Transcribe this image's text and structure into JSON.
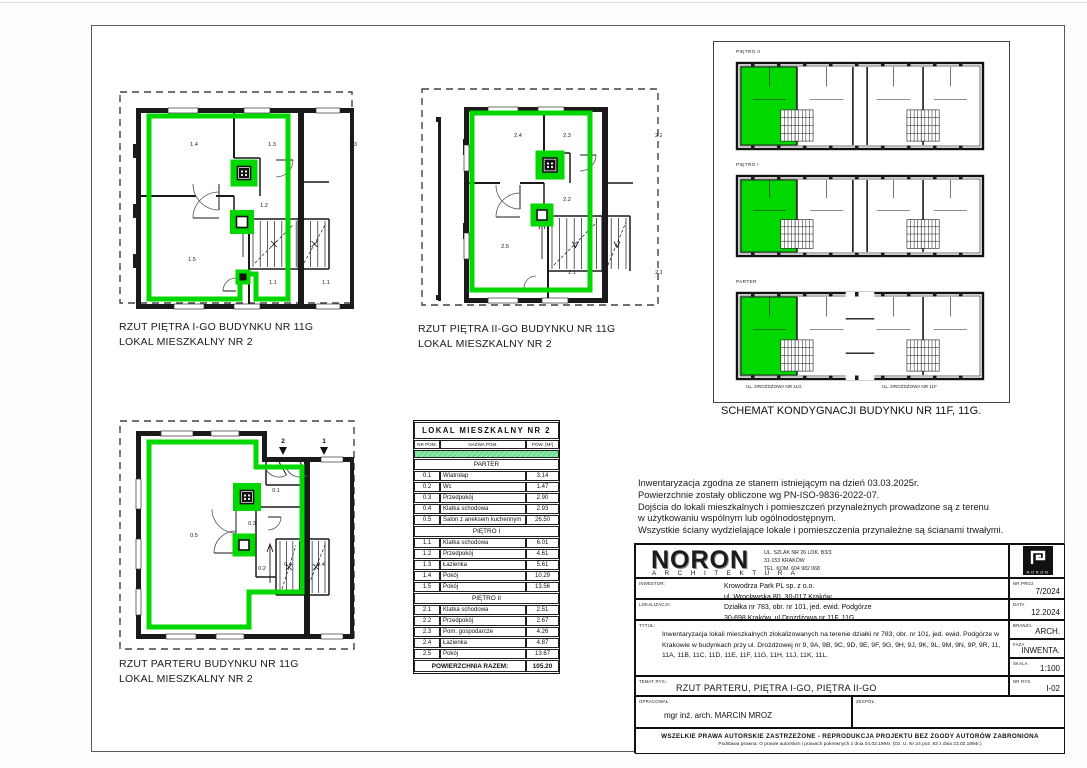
{
  "colors": {
    "highlight_green": "#00d800",
    "table_row_green": "#8ce9a6"
  },
  "plans": [
    {
      "caption1": "RZUT PIĘTRA I-GO BUDYNKU NR 11G",
      "caption2": "LOKAL MIESZKALNY NR 2",
      "rooms": [
        "1.4",
        "1.3",
        "1.2",
        "1.5",
        "1.1",
        "1.1",
        "1.3"
      ]
    },
    {
      "caption1": "RZUT PIĘTRA II-GO BUDYNKU NR 11G",
      "caption2": "LOKAL MIESZKALNY NR 2",
      "rooms": [
        "2.4",
        "2.3",
        "2.2",
        "2.5",
        "2.1",
        "2.2",
        "2.1"
      ]
    },
    {
      "caption1": "RZUT PARTERU BUDYNKU NR 11G",
      "caption2": "LOKAL MIESZKALNY NR 2",
      "rooms": [
        "0.5",
        "0.1",
        "0.3",
        "0.2",
        "0.4",
        "0.4"
      ],
      "entry_markers": [
        "2",
        "1"
      ]
    }
  ],
  "schematic": {
    "caption": "SCHEMAT KONDYGNACJI  BUDYNKU NR 11F, 11G.",
    "floor_labels": [
      "PIĘTRO II",
      "PIĘTRO I",
      "PARTER"
    ],
    "street_labels": [
      "UL. DROŻDŻOWA NR 11G",
      "UL. DROŻDŻOWA NR 11F"
    ]
  },
  "area_table": {
    "title": "LOKAL MIESZKALNY NR 2",
    "headers": [
      "NR POM.",
      "NAZWA POM.",
      "POW. [M²]"
    ],
    "sections": [
      {
        "name": "PARTER",
        "rows": [
          [
            "0.1",
            "Wiatrołap",
            "3.14"
          ],
          [
            "0.2",
            "Wc",
            "1.47"
          ],
          [
            "0.3",
            "Przedpokój",
            "2.90"
          ],
          [
            "0.4",
            "Klatka schodowa",
            "2.93"
          ],
          [
            "0.5",
            "Salon z aneksem kuchennym",
            "26.50"
          ]
        ]
      },
      {
        "name": "PIĘTRO I",
        "rows": [
          [
            "1.1",
            "Klatka schodowa",
            "6.01"
          ],
          [
            "1.2",
            "Przedpokój",
            "4.61"
          ],
          [
            "1.3",
            "Łazienka",
            "5.61"
          ],
          [
            "1.4",
            "Pokój",
            "10.29"
          ],
          [
            "1.5",
            "Pokój",
            "13.56"
          ]
        ]
      },
      {
        "name": "PIĘTRO II",
        "rows": [
          [
            "2.1",
            "Klatka schodowa",
            "2.51"
          ],
          [
            "2.2",
            "Przedpokój",
            "2.67"
          ],
          [
            "2.3",
            "Pom. gospodarcze",
            "4.26"
          ],
          [
            "2.4",
            "Łazienka",
            "4.87"
          ],
          [
            "2.5",
            "Pokój",
            "13.67"
          ]
        ]
      }
    ],
    "total_label": "POWIERZCHNIA RAZEM:",
    "total_value": "105.20"
  },
  "notes": {
    "lines": [
      "Inwentaryzacja zgodna ze stanem istniejącym na dzień 03.03.2025r.",
      "Powierzchnie zostały obliczone wg PN-ISO-9836-2022-07.",
      "Dojścia do lokali mieszkalnych i pomieszczeń przynależnych prowadzone są z terenu",
      "w użytkowaniu wspólnym lub ogólnodostępnym.",
      "Wszystkie ściany wydzielające lokale i pomieszczenia przynależne są ścianami trwałymi."
    ]
  },
  "title_block": {
    "company": {
      "name": "NORON",
      "subtitle": "A R C H I T E K T U R A",
      "address_lines": [
        "UL. SZLAK NR 26 LOK. B3/3",
        "31-153 KRAKÓW",
        "TEL. KOM. 604 982 068"
      ],
      "logo_text": "NORON"
    },
    "fields": {
      "inwestor_label": "INWESTOR:",
      "inwestor_value": "Krowodrza Park PL sp. z o.o.\nul. Wrocławska 80, 30-017 Kraków",
      "lokalizacja_label": "LOKALIZACJA:",
      "lokalizacja_value": "Działka nr 783, obr. nr 101,  jed. ewid. Podgórze\n30-698 Kraków, ul Drożdżowa nr 11F, 11G.",
      "tytul_label": "TYTUŁ:",
      "tytul_value": "Inwentaryzacja lokali mieszkalnych zlokalizowanych na terenie działki nr 783, obr. nr 101, jed. ewid. Podgórze  w Krakowie w budynkach przy ul. Drożdżowej nr 9, 9A, 9B, 9C, 9D, 9E, 9F, 9G, 9H, 9J, 9K, 9L, 9M, 9N, 9P, 9R, 11, 11A, 11B, 11C, 11D, 11E, 11F, 11G, 11H, 11J, 11K, 11L.",
      "temat_label": "TEMAT RYS.:",
      "temat_value": "RZUT PARTERU, PIĘTRA I-GO, PIĘTRA II-GO",
      "opracowal_label": "OPRACOWAŁ:",
      "opracowal_value": "mgr inż. arch. MARCIN MROZ\nMPOIA/010/2004",
      "zespol_label": "ZESPÓŁ:",
      "nr_proj_label": "NR.PROJ.",
      "nr_proj_value": "7/2024",
      "data_label": "DATA",
      "data_value": "12.2024",
      "branza_label": "BRANŻA",
      "branza_value": "ARCH.",
      "faza_label": "FAZA",
      "faza_value": "INWENTA.",
      "skala_label": "SKALA",
      "skala_value": "1:100",
      "nr_rys_label": "NR RYS.",
      "nr_rys_value": "I-02"
    },
    "copyright_line1": "WSZELKIE PRAWA AUTORSKIE ZASTRZEŻONE - REPRODUKCJA PROJEKTU BEZ ZGODY AUTORÓW ZABRONIONA",
    "copyright_line2": "Podstawa prawna: O prawie autorskim i prawach pokrewnych z dnia 04.02.1994r. (Dz. U. Nr 24 poz. 83 z dnia 23.02.1994r.)"
  }
}
